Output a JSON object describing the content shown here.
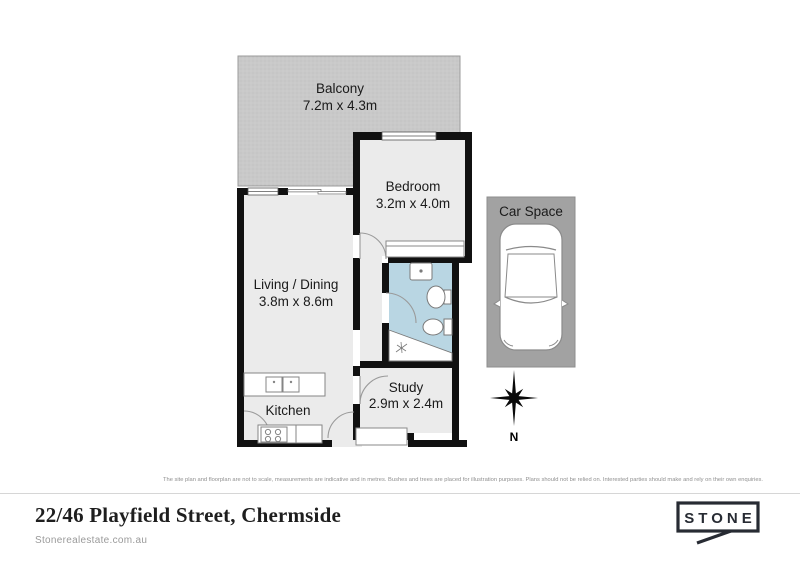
{
  "rooms": {
    "balcony": {
      "label": "Balcony",
      "dims": "7.2m x 4.3m"
    },
    "bedroom": {
      "label": "Bedroom",
      "dims": "3.2m x 4.0m"
    },
    "living": {
      "label": "Living / Dining",
      "dims": "3.8m x 8.6m"
    },
    "kitchen": {
      "label": "Kitchen"
    },
    "study": {
      "label": "Study",
      "dims": "2.9m x 2.4m"
    },
    "car_space": {
      "label": "Car Space"
    }
  },
  "compass": {
    "north_label": "N"
  },
  "disclaimer": "The site plan and floorplan are not to scale, measurements are indicative and in metres. Bushes and trees are placed for illustration purposes. Plans should not be relied on. Interested parties should make and rely on their own enquiries.",
  "footer": {
    "address": "22/46 Playfield Street, Chermside",
    "website": "Stonerealestate.com.au",
    "logo_text": "STONE"
  },
  "colors": {
    "balcony_fill": "#c9c9c9",
    "carspace_fill": "#a2a2a2",
    "floor_fill": "#ebebeb",
    "wall": "#111111",
    "bathroom_fill": "#b9d6e3",
    "fixture_stroke": "#858585",
    "divider": "#d6d6d6",
    "muted_text": "#8f8f8f",
    "logo": "#272b33"
  }
}
